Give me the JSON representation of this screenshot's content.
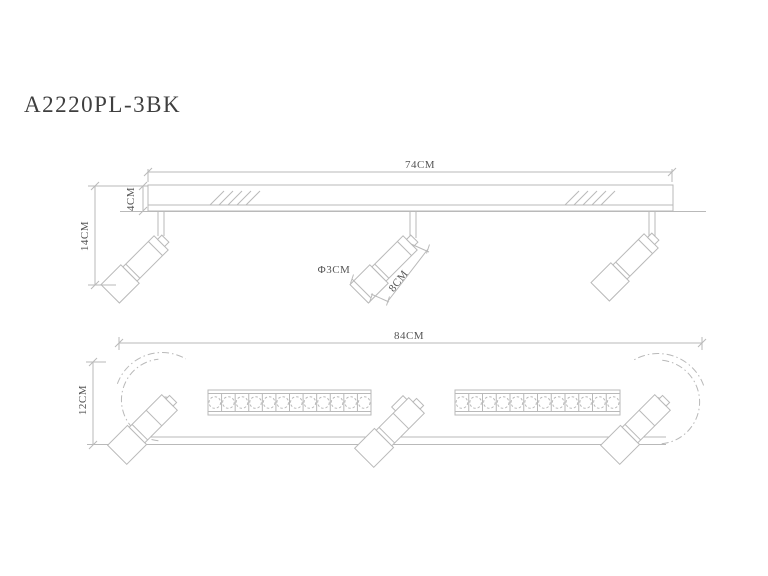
{
  "title": "A2220PL-3BK",
  "colors": {
    "line": "#b9b9b9",
    "text": "#555555",
    "background": "#ffffff"
  },
  "views": {
    "top": {
      "name": "top view",
      "dimensions": {
        "bar_width": "74CM",
        "bar_height": "4CM",
        "fixture_height": "14CM",
        "head_diameter": "Φ3CM",
        "head_length": "8CM"
      },
      "spotlight_count": 3
    },
    "bottom": {
      "name": "bottom view",
      "dimensions": {
        "overall_width": "84CM",
        "fixture_depth": "12CM"
      },
      "spotlight_count": 3,
      "led_strips": {
        "count": 2,
        "cells_per_strip": 12
      }
    }
  }
}
